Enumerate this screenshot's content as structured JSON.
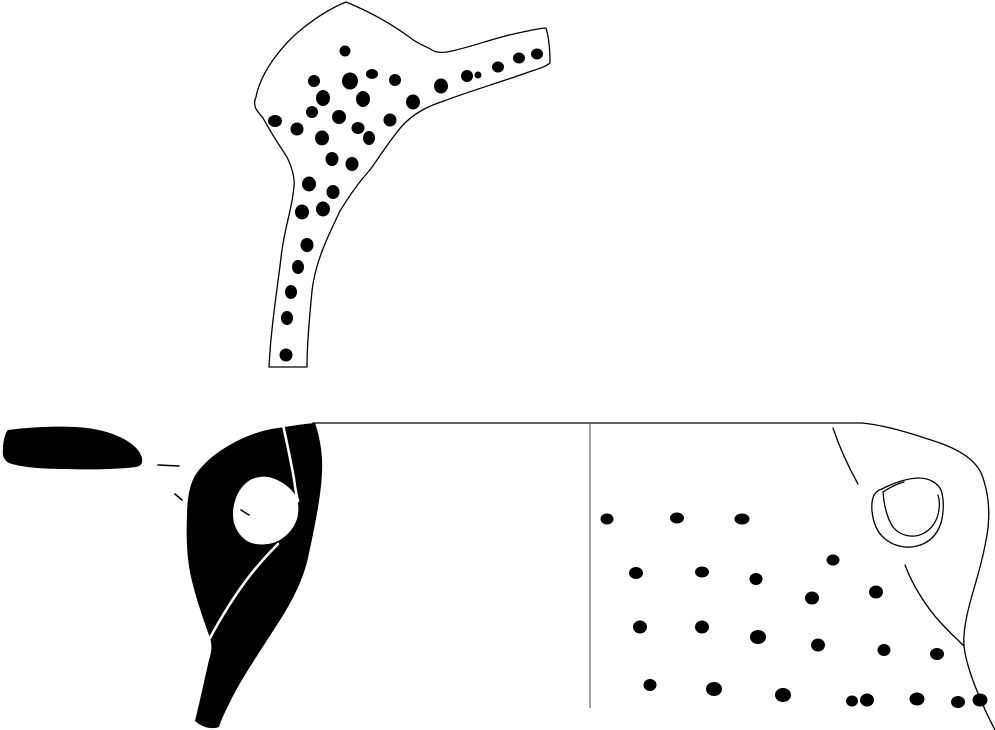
{
  "canvas": {
    "width": 995,
    "height": 730,
    "background": "#ffffff",
    "ink": "#000000",
    "divider": "#7a7a7a",
    "highlight": "#ffffff"
  },
  "shapes": {
    "top_fragment": {
      "outline": "M346,2 C368,11 392,24 412,39 C420,45 426,46 432,50 C436,53 444,53 452,51 C474,46 498,37 518,33 C528,31 540,28 546,28 C549,38 550,52 550,63 C544,68 534,70 526,73 C498,83 464,93 444,101 C428,106 414,113 402,126 C389,141 377,161 369,171 C360,181 351,193 340,211 C327,238 315,263 312,291 C309,321 307,348 307,367 L269,367 C271,327 277,291 281,258 C284,228 292,211 294,186 C295,178 291,163 285,154 C279,145 269,129 263,118 C257,111 252,106 256,97 C261,71 283,44 303,28 C322,13 336,6 346,2 Z",
      "dots": [
        [
          345,
          51,
          5.5,
          5.5
        ],
        [
          372,
          74,
          6,
          5
        ],
        [
          350,
          81,
          8,
          8.5
        ],
        [
          395,
          80,
          6,
          6
        ],
        [
          441,
          86,
          7,
          7.5
        ],
        [
          467,
          76,
          6,
          6
        ],
        [
          478,
          75,
          3.5,
          3.5
        ],
        [
          498,
          67,
          6,
          5.5
        ],
        [
          519,
          58,
          6,
          5.5
        ],
        [
          537,
          54,
          6,
          5.5
        ],
        [
          314,
          81,
          6,
          6
        ],
        [
          323,
          98,
          7,
          8
        ],
        [
          363,
          99,
          7,
          8
        ],
        [
          413,
          102,
          7,
          7.5
        ],
        [
          312,
          112,
          6,
          6
        ],
        [
          339,
          117,
          7,
          7
        ],
        [
          390,
          120,
          6.5,
          6.5
        ],
        [
          275,
          121,
          7,
          6
        ],
        [
          297,
          129,
          6.5,
          6.5
        ],
        [
          322,
          138,
          7,
          7.5
        ],
        [
          358,
          128,
          6.5,
          6
        ],
        [
          369,
          138,
          6,
          7
        ],
        [
          332,
          159,
          6.5,
          7
        ],
        [
          352,
          164,
          6.5,
          7
        ],
        [
          309,
          184,
          7,
          7.5
        ],
        [
          333,
          192,
          6.5,
          7
        ],
        [
          302,
          212,
          7,
          7.5
        ],
        [
          323,
          209,
          7,
          7.5
        ],
        [
          307,
          245,
          6.5,
          7
        ],
        [
          298,
          267,
          6,
          7
        ],
        [
          291,
          292,
          6,
          7
        ],
        [
          287,
          318,
          6,
          7
        ],
        [
          286,
          355,
          6.5,
          6.5
        ]
      ]
    },
    "rim_section": {
      "path": "M8,430 C30,427 55,426 75,427 C95,428 110,432 122,438 C132,443 140,450 142,458 C143,463 141,466 136,467 C120,469 90,470 65,469 C40,469 20,467 9,463 C4,460 2,456 3,449 C3,442 5,433 8,430 Z"
    },
    "ticks": [
      "M158,465 L179,466",
      "M175,494 L182,500"
    ],
    "handle_section": {
      "body": "M315,423 C320,437 323,456 322,472 C321,494 317,516 308,558 C302,584 289,607 273,631 C257,656 240,681 229,704 C225,712 221,720 219,727 C211,730 202,727 195,721 C199,705 204,682 209,660 C212,650 212,645 210,638 C204,621 196,599 191,577 C187,559 186,537 187,516 C187,498 190,483 196,474 C203,464 214,454 228,446 C245,436 262,430 278,428 C291,426 303,424 315,423 Z M233,512 C234,500 238,490 246,483 C253,477 264,475 272,478 C282,481 291,488 296,496 C299,503 299,512 297,519 C294,528 288,535 280,540 C271,545 258,546 249,542 C241,538 236,530 234,523 C233,519 233,515 233,512 Z",
      "white_line_upper": "M283,425 C287,443 291,462 294,479 C295,487 296,494 298,501",
      "white_line_lower": "M278,544 C268,554 256,567 245,582 C233,598 219,621 210,638",
      "hole_tick": "M241,510 L249,515"
    },
    "vessel_fragment": {
      "top_and_right_profile": "M313,423 L862,423 C884,425 910,433 934,441 C959,449 976,460 982,475 C988,492 990,508 988,528 C985,551 978,575 971,599 C966,617 963,633 964,646 C966,664 974,685 983,705 C988,717 992,724 995,730",
      "divider": "M590,424 L590,708",
      "shoulder_crease": "M833,428 C839,446 848,466 858,484",
      "below_lug_curve": "M905,565 C912,584 926,607 941,623 C950,633 958,640 964,646",
      "lug_outer": "M872,511 C871,499 874,491 882,489 C893,483 908,478 919,478 C928,478 937,482 941,490 C944,498 944,512 941,523 C937,535 929,543 917,546 C906,549 893,546 884,538 C876,531 873,521 872,511 Z",
      "lug_inner": "M883,492 C884,505 887,518 893,527 C900,536 914,539 924,533 C932,529 938,520 939,509 C940,503 939,498 938,495",
      "lug_strap": "M883,492 C889,488 896,484 904,482",
      "dots": [
        [
          607,
          519,
          6.5,
          5.5
        ],
        [
          677,
          518,
          7,
          5.5
        ],
        [
          742,
          519,
          7.5,
          5.5
        ],
        [
          833,
          560,
          6.5,
          5.5
        ],
        [
          636,
          573,
          7,
          6
        ],
        [
          702,
          572,
          7,
          5.5
        ],
        [
          756,
          579,
          6.5,
          6
        ],
        [
          812,
          598,
          7,
          6.5
        ],
        [
          876,
          592,
          7,
          6.5
        ],
        [
          640,
          627,
          7,
          6.5
        ],
        [
          702,
          627,
          7,
          6.5
        ],
        [
          758,
          637,
          8,
          7
        ],
        [
          818,
          645,
          7,
          6.5
        ],
        [
          884,
          650,
          6.5,
          6
        ],
        [
          937,
          654,
          7,
          6
        ],
        [
          650,
          685,
          6.5,
          6
        ],
        [
          714,
          689,
          8,
          7
        ],
        [
          783,
          695,
          8,
          7
        ],
        [
          852,
          701,
          6,
          5.5
        ],
        [
          867,
          700,
          7,
          6.5
        ],
        [
          917,
          699,
          7.5,
          6.5
        ],
        [
          958,
          702,
          7,
          6
        ],
        [
          980,
          700,
          7.5,
          6.5
        ]
      ]
    }
  }
}
